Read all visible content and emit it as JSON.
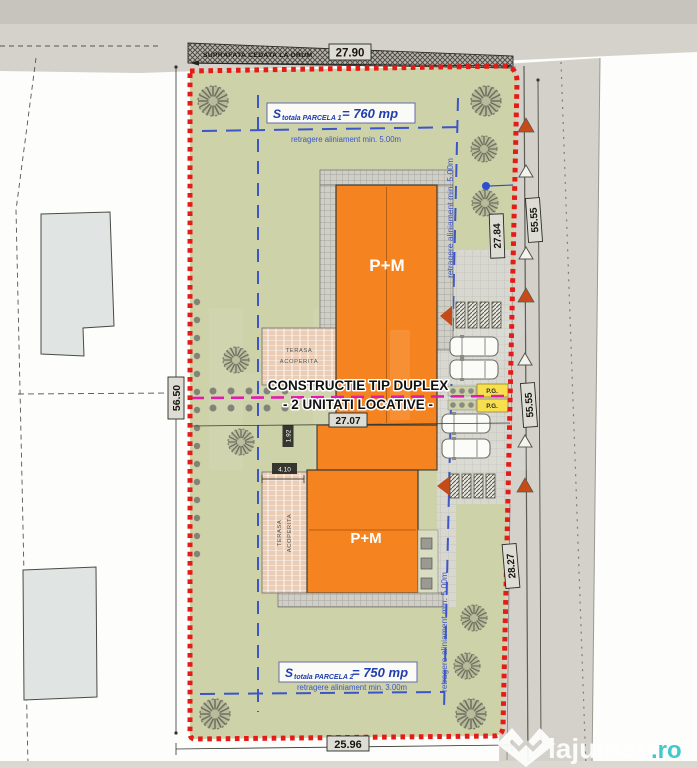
{
  "title_block": {
    "road_cession_label": "SUPRAFATA CEDATA LA DRUM",
    "construction_title_line1": "CONSTRUCTIE TIP DUPLEX",
    "construction_title_line2": "- 2 UNITATI LOCATIVE -"
  },
  "parcels": {
    "parcel1": {
      "prefix": "S",
      "subscript": "totala PARCELA 1",
      "value": "= 760 mp",
      "front_setback": "retragere aliniament min. 5.00m"
    },
    "parcel2": {
      "prefix": "S",
      "subscript": "totala PARCELA 2",
      "value": "= 750 mp",
      "rear_setback": "retragere aliniament min. 3.00m"
    },
    "side_setback_upper": "retragere aliniament min. 5.00m",
    "side_setback_lower": "retragere aliniament min. 5.00m"
  },
  "buildings": {
    "unit1_label": "P+M",
    "unit2_label": "P+M",
    "terrace_word1": "TERASA",
    "terrace_word2": "ACOPERITA",
    "parking_garage": "P.G."
  },
  "dimensions": {
    "top_width": "27.90",
    "bottom_width": "25.96",
    "left_depth": "56.50",
    "right_upper": "27.84",
    "right_lower": "28.27",
    "road_segment_upper": "55.55",
    "road_segment_lower": "55.55",
    "parcel_split_width": "27.07",
    "small_offset": "1.92",
    "terrace_width": "4.10"
  },
  "watermark": {
    "brand": "lajumate",
    "tld": ".ro",
    "background_letters": "HZ"
  },
  "colors": {
    "parcel_green": "#cdd2a8",
    "building_orange": "#f5831f",
    "boundary_red": "#e41b17",
    "setback_blue": "#3c55c8",
    "split_magenta": "#e619ae",
    "pg_yellow": "#f7df4e"
  }
}
